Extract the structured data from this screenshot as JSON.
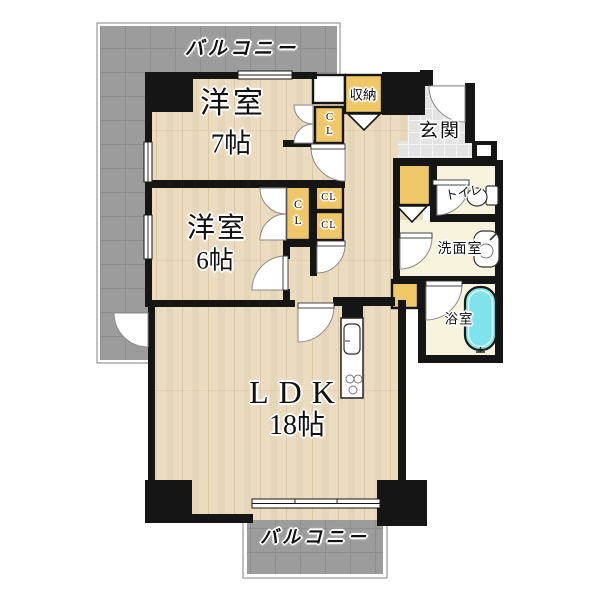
{
  "plan": {
    "balcony_top_label": "バルコニー",
    "balcony_bottom_label": "バルコニー",
    "rooms": {
      "western7": {
        "name": "洋室",
        "size": "7帖"
      },
      "western6": {
        "name": "洋室",
        "size": "6帖"
      },
      "ldk": {
        "name": "LDK",
        "size": "18帖"
      },
      "entrance": {
        "name": "玄関"
      },
      "toilet": {
        "name": "トイレ"
      },
      "washroom": {
        "name": "洗面室"
      },
      "bathroom": {
        "name": "浴室"
      }
    },
    "storage": {
      "shuno_label": "収納",
      "closet_label": "CL"
    },
    "colors": {
      "wood_floor": "#ebdcc0",
      "wood_grain": "#d8c4a0",
      "balcony_gray": "#9c9c9c",
      "balcony_grout": "#8e8e8e",
      "closet_yellow": "#f0c767",
      "service_room_cream": "#f7f3dc",
      "entrance_tile": "#e3e3e3",
      "bathtub_cyan": "#7fe3ec",
      "wall_black": "#151515"
    }
  }
}
